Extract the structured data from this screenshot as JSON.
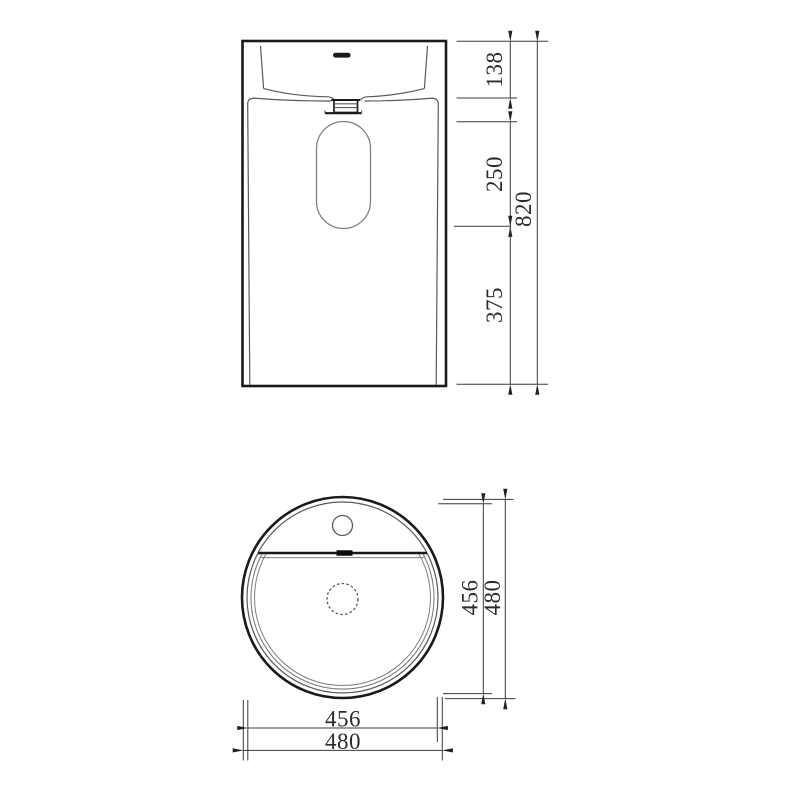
{
  "drawing": {
    "type": "technical-dimension-drawing",
    "subject": "pedestal wash basin",
    "views": {
      "front": {
        "label": "front elevation view",
        "dimensions": {
          "basin_rim_height": "138",
          "cutout_height": "250",
          "cutout_to_floor": "375",
          "overall_height": "820"
        }
      },
      "top": {
        "label": "top plan view",
        "dimensions": {
          "inner_diameter_vertical": "456",
          "outer_diameter_vertical": "480",
          "inner_diameter_horizontal": "456",
          "outer_diameter_horizontal": "480"
        }
      }
    },
    "colors": {
      "background": "#ffffff",
      "bold_line": "#1a1a1a",
      "thin_line": "#5a5a5a",
      "light_line": "#7e7e7e",
      "dimension_line": "#3a3a3a",
      "text": "#2b2b2b"
    }
  }
}
